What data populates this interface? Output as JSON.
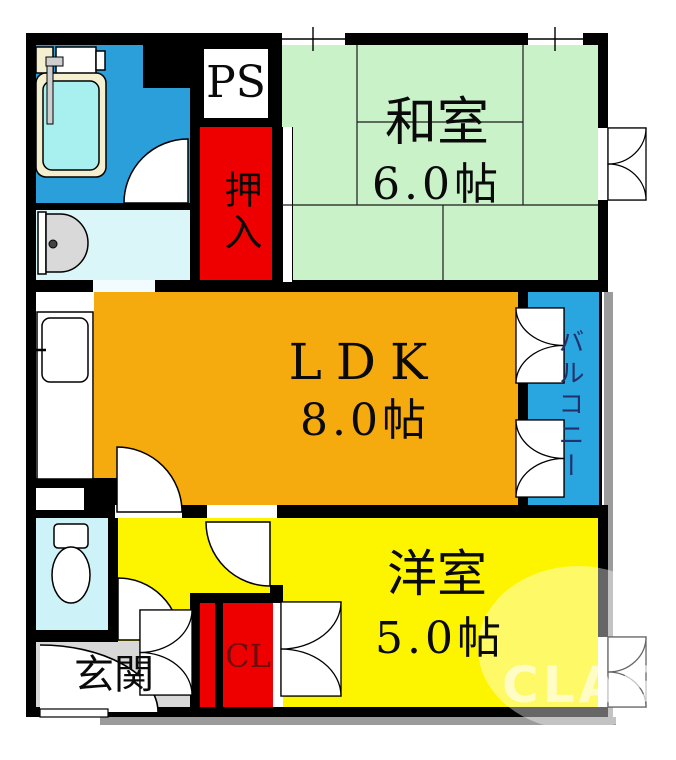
{
  "plan_title": "apartment-floor-plan",
  "rooms": {
    "washitsu": {
      "name": "和室",
      "size": "6.0帖"
    },
    "ldk": {
      "name": "LDK",
      "size": "8.0帖"
    },
    "yoshitsu": {
      "name": "洋室",
      "size": "5.0帖"
    },
    "oshiire": {
      "name": "押入"
    },
    "ps": {
      "name": "PS"
    },
    "cl": {
      "name": "CL"
    },
    "genkan": {
      "name": "玄関"
    },
    "balcony": {
      "name": "バルコニー"
    }
  },
  "watermark": "CLAS",
  "colors": {
    "bath": "#2b9fd9",
    "wash": "#dbf6f9",
    "toilet": "#cdf3f8",
    "tatami": "#c9f2c9",
    "ldk": "#f5aa0d",
    "yoshitsu": "#fdf500",
    "balcony": "#29a5df",
    "genkan": "#d8d8d8",
    "closet_red": "#ee0000",
    "shadow": "#9b9b9b",
    "balcony_ink": "#23306b",
    "cl_ink": "#6d0d0d"
  }
}
